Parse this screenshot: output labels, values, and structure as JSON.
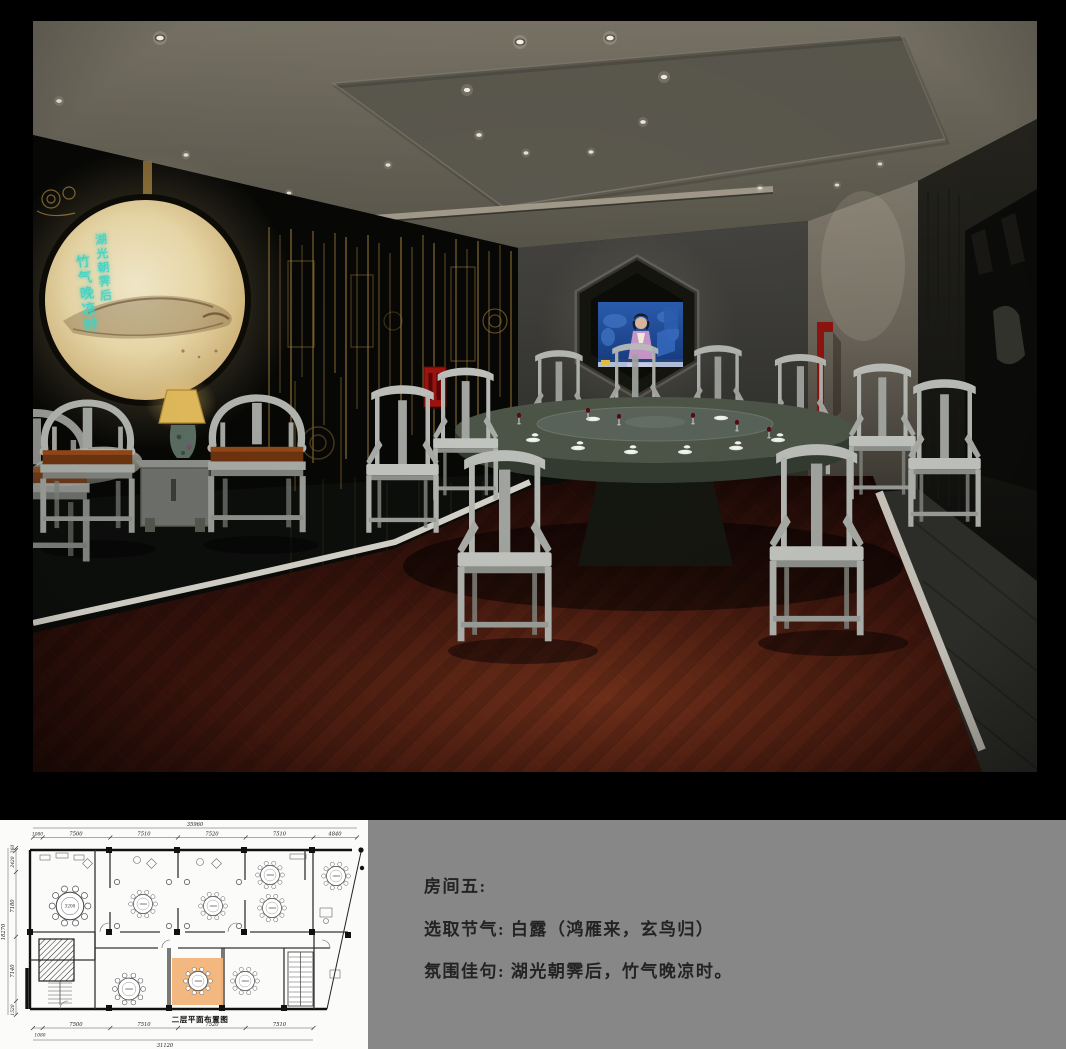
{
  "render": {
    "moon_calligraphy": {
      "column1": "湖光朝霁后",
      "column2": "竹气晚凉时"
    }
  },
  "floor_plan": {
    "title": "二层平面布置图",
    "top_overall": "35960",
    "top_segments": [
      "1080",
      "7500",
      "7510",
      "7520",
      "7510",
      "4840"
    ],
    "left_overall": "18270",
    "left_segments": [
      "260",
      "2420",
      "7180",
      "7140",
      "1520"
    ],
    "bottom_segments": [
      "7500",
      "7510",
      "7520",
      "7510"
    ],
    "bottom_lead": "1080",
    "bottom_overall": "31120",
    "tables": {
      "t1": "3200",
      "t2": "1600",
      "t3": "1600",
      "t4": "1600",
      "t5": "1800",
      "t6": "1800",
      "t7": "2000",
      "t8": "1600",
      "t9": "1800"
    }
  },
  "caption": {
    "line1": "房间五:",
    "line2": "选取节气: 白露（鸿雁来，玄鸟归）",
    "line3": "氛围佳句: 湖光朝霁后，竹气晚凉时。"
  },
  "colors": {
    "accent_red": "#9c130e",
    "gold": "#a9863e",
    "calligraphy_teal": "#41d1c3",
    "plan_highlight_orange": "#f2b478",
    "panel_gray": "#878787",
    "marble_white": "#d6d3ca"
  }
}
